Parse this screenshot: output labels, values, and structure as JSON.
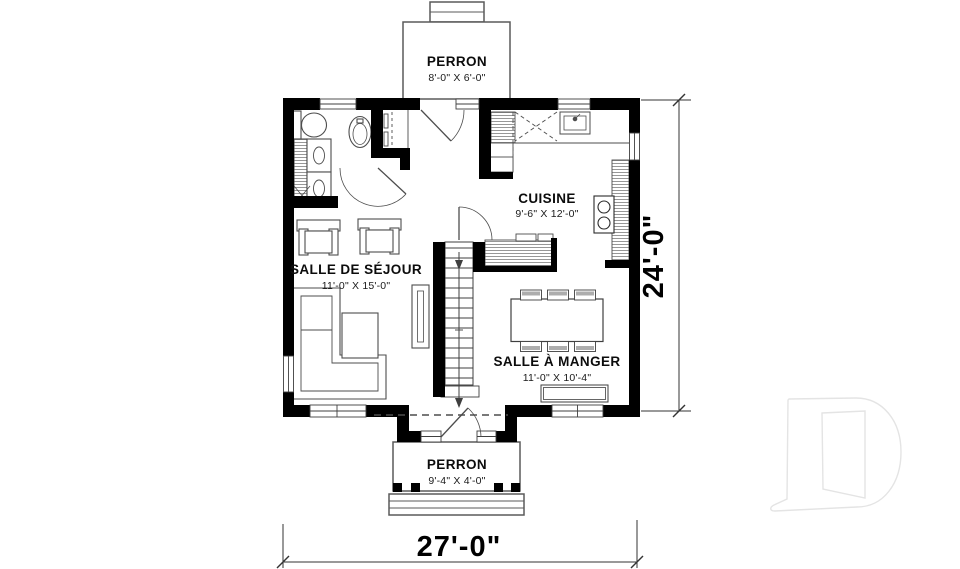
{
  "rooms": {
    "cuisine": {
      "label": "CUISINE",
      "dims": "9'-6\" X 12'-0\""
    },
    "sejour": {
      "label": "SALLE DE SÉJOUR",
      "dims": "11'-0\" X 15'-0\""
    },
    "manger": {
      "label": "SALLE À MANGER",
      "dims": "11'-0\" X 10'-4\""
    },
    "perron_top": {
      "label": "PERRON",
      "dims": "8'-0\" X 6'-0\""
    },
    "perron_bottom": {
      "label": "PERRON",
      "dims": "9'-4\" X 4'-0\""
    }
  },
  "dimensions": {
    "overall_width": "27'-0\"",
    "overall_height": "24'-0\""
  },
  "colors": {
    "walls": "#000000",
    "thin_lines": "#4d4d4d",
    "watermark": "#e4e4e4",
    "background": "#ffffff"
  },
  "icons": {
    "builder_logo": "stylized-D-watermark"
  }
}
